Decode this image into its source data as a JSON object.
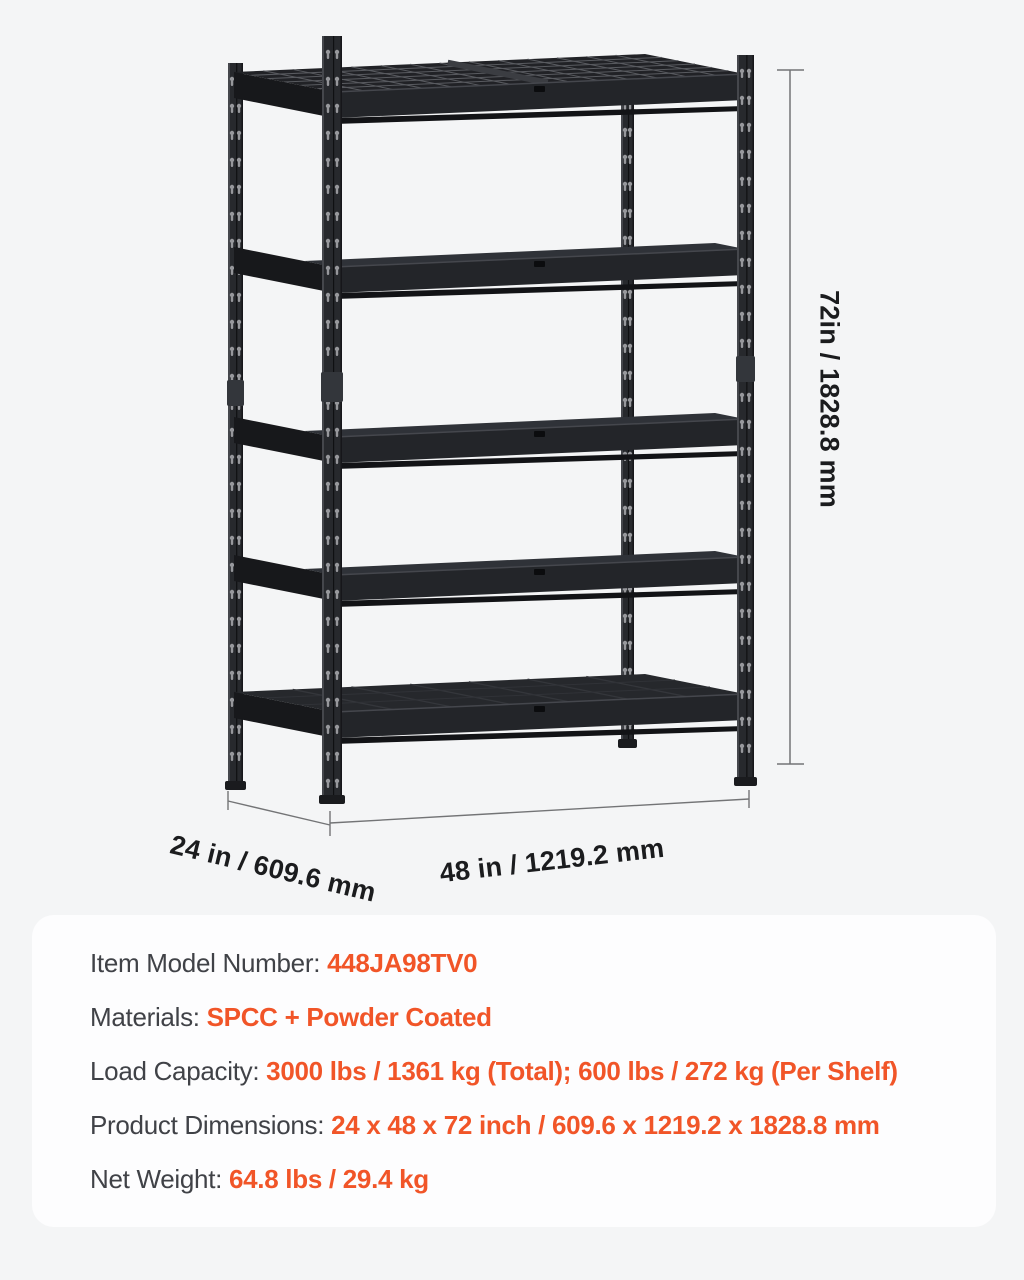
{
  "page": {
    "background_color": "#f4f5f6",
    "panel_color": "#fdfdfe"
  },
  "figure": {
    "description": "Black 5-tier boltless steel storage shelving unit shown in perspective with measurement lines",
    "height_label": "72in / 1828.8 mm",
    "depth_label": "24 in / 609.6 mm",
    "width_label": "48 in / 1219.2 mm"
  },
  "specs": {
    "accent_color": "#f15528",
    "label_color": "#404247",
    "rows": [
      {
        "label": "Item Model Number: ",
        "value": "448JA98TV0"
      },
      {
        "label": "Materials: ",
        "value": "SPCC + Powder Coated"
      },
      {
        "label": "Load Capacity: ",
        "value": "3000 lbs / 1361 kg (Total); 600 lbs / 272 kg (Per Shelf)"
      },
      {
        "label": "Product Dimensions: ",
        "value": "24 x 48 x 72 inch / 609.6 x 1219.2 x 1828.8 mm"
      },
      {
        "label": "Net Weight: ",
        "value": "64.8 lbs / 29.4 kg"
      }
    ]
  }
}
